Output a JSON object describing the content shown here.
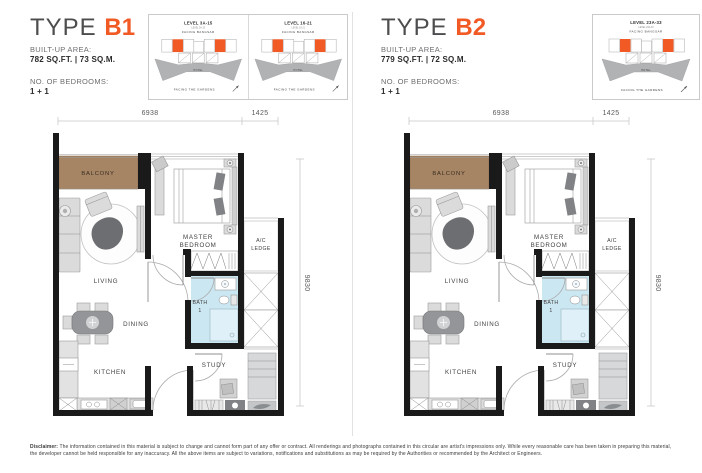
{
  "colors": {
    "accent_orange": "#F15A25",
    "balcony_brown": "#A68565",
    "bath_blue": "#CBE7F1",
    "wall_black": "#1A1A1A"
  },
  "type_b1": {
    "title_prefix": "TYPE",
    "title_code": "B1",
    "built_up_label": "BUILT-UP AREA:",
    "built_up_value": "782 SQ.FT. | 73 SQ.M.",
    "bedrooms_label": "NO. OF BEDROOMS:",
    "bedrooms_value": "1 + 1",
    "key_plans": [
      {
        "level": "LEVEL 3A-15",
        "sub_level": "LEVEL 3A-15",
        "facing_top": "FACING BANGSAR",
        "hotel": "HOTEL",
        "facing_bottom": "FACING THE GARDENS"
      },
      {
        "level": "LEVEL 16-21",
        "sub_level": "LEVEL 16-21",
        "facing_top": "FACING BANGSAR",
        "hotel": "HOTEL",
        "facing_bottom": "FACING THE GARDENS"
      }
    ]
  },
  "type_b2": {
    "title_prefix": "TYPE",
    "title_code": "B2",
    "built_up_label": "BUILT-UP AREA:",
    "built_up_value": "779 SQ.FT. | 72 SQ.M.",
    "bedrooms_label": "NO. OF BEDROOMS:",
    "bedrooms_value": "1 + 1",
    "key_plans": [
      {
        "level": "LEVEL 23A-33",
        "sub_level": "LEVEL 23A-33",
        "facing_top": "FACING BANGSAR",
        "hotel": "HOTEL",
        "facing_bottom": "FACING THE GARDENS"
      }
    ]
  },
  "floor_plan": {
    "rooms": {
      "balcony": "BALCONY",
      "living": "LIVING",
      "dining": "DINING",
      "kitchen": "KITCHEN",
      "master_bedroom_line1": "MASTER",
      "master_bedroom_line2": "BEDROOM",
      "ac_ledge_line1": "A/C",
      "ac_ledge_line2": "LEDGE",
      "bath_line1": "BATH",
      "bath_line2": "1",
      "study": "STUDY"
    },
    "dimensions": {
      "width_main": "6938",
      "width_right": "1425",
      "height": "9830"
    }
  },
  "disclaimer": {
    "label": "Disclaimer:",
    "text1": "The information contained in this material is subject to change and cannot form part of any offer or contract. All renderings and photographs contained in this circular are artist's impressions only. While every reasonable care has been taken in preparing this material, the developer cannot be held responsible for any inaccuracy.",
    "text2": "All the above items are subject to variations, notifications and substitutions as may be required by the Authorities or recommended by the Architect or Engineers."
  }
}
